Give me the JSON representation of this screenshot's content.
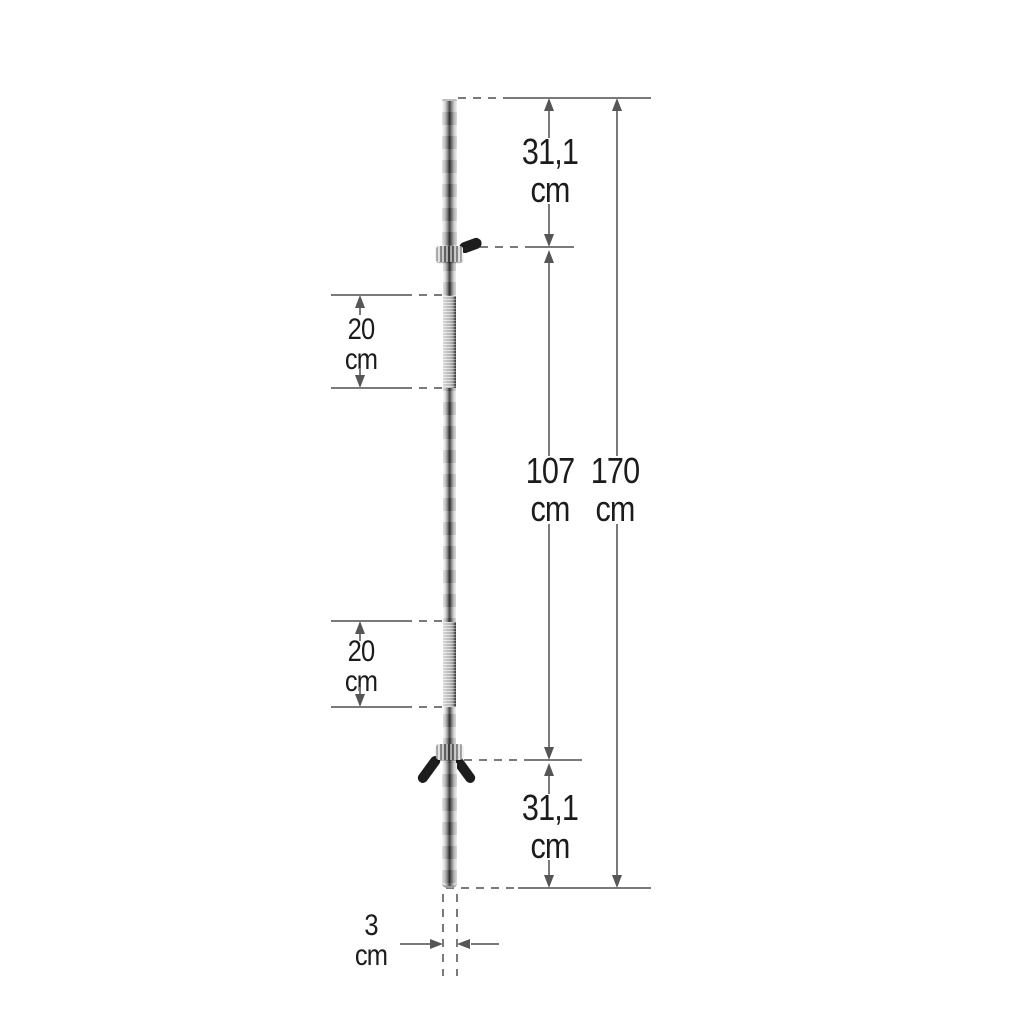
{
  "colors": {
    "line": "#7a7a7a",
    "arrow": "#565656",
    "text": "#1c1c1c",
    "background": "#ffffff",
    "knob": "#1d1d1d"
  },
  "dimensions": {
    "top_section": {
      "value": "31,1",
      "unit": "cm"
    },
    "grip_upper": {
      "value": "20",
      "unit": "cm"
    },
    "shaft_between_collars": {
      "value": "107",
      "unit": "cm"
    },
    "total_length": {
      "value": "170",
      "unit": "cm"
    },
    "grip_lower": {
      "value": "20",
      "unit": "cm"
    },
    "bottom_section": {
      "value": "31,1",
      "unit": "cm"
    },
    "bar_diameter": {
      "value": "3",
      "unit": "cm"
    }
  }
}
